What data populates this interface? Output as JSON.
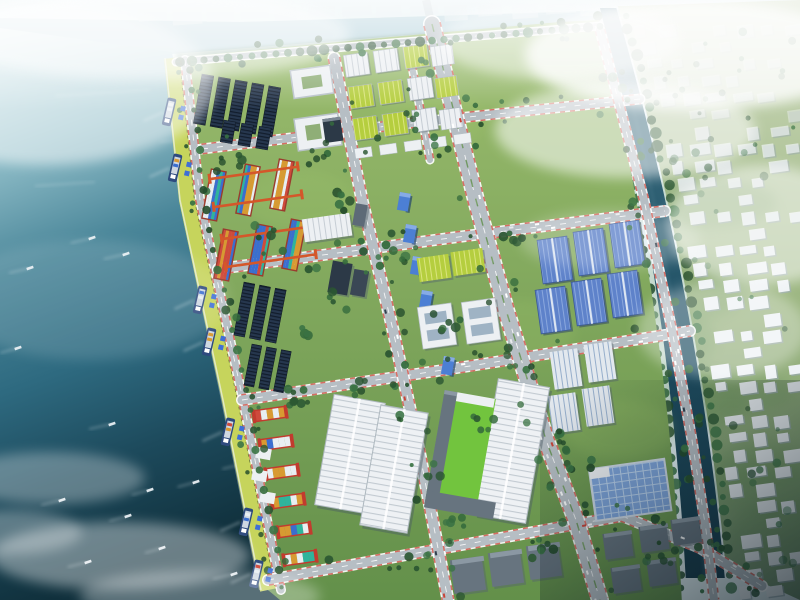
{
  "meta": {
    "type": "aerial-architectural-rendering",
    "subject": "coastal industrial port and logistics park master plan",
    "view": "oblique bird's-eye",
    "width": 800,
    "height": 600
  },
  "scene": {
    "sea": {
      "position": "left",
      "moored_ships": 7,
      "small_boats": 16,
      "wake_streaks": 5,
      "clouds_bottom_left": 4
    },
    "quay": {
      "edge": "yellow-green apron with rail line",
      "portal_cranes": 7
    },
    "industrial_park": {
      "solar_panel_fields": 2,
      "container_yard_north": {
        "rows": 2,
        "stacks": 6,
        "gantry_cranes": "orange"
      },
      "container_yard_south": {
        "stacks": 6,
        "frames": "red"
      },
      "courtyard_buildings": 2,
      "workshop_rows": "white and yellow-green roofs",
      "office_cluster": "dark and gray mid-rise slabs",
      "blue_glass_towers": 6,
      "green_roof_buildings": 2,
      "white_panel_buildings": 2,
      "blue_warehouses": 6,
      "striped_warehouses": 4,
      "large_ribbed_warehouses": 3,
      "glass_roof_warehouse": 1,
      "sports_green_field": 1,
      "gray_warehouse_clusters": 2,
      "road_grid": {
        "vertical_roads": 4,
        "horizontal_roads": 5,
        "curbs": "red-white striped",
        "boulevard": "tree-lined median"
      }
    },
    "river": {
      "position": "right",
      "orientation": "north-south",
      "banks": "tree-lined",
      "bridges": 2
    },
    "east_bank_village": {
      "buildings": "small white low-rise blocks",
      "ground": "hazy green",
      "shading": "dark toward bottom-right"
    },
    "top_shoreline": {
      "water_band": true,
      "city_blocks": "hazy silhouettes",
      "bridge": true
    },
    "atmosphere": {
      "haze": "white cloud banks top-right, top-left and bottom-left",
      "lighting": "overcast daylight"
    }
  },
  "palette": {
    "haze_base": "#e3f0f3",
    "water_band": "#accdd7",
    "sea_stops": [
      "#d8ecef",
      "#8fbdc8",
      "#4a8699",
      "#2e6a80",
      "#1d4a5c",
      "#10303c"
    ],
    "grass_top": "#9cbd6e",
    "grass_bottom": "#63904a",
    "bright_field": "#72c43e",
    "quay_strip": "#c6d45c",
    "rail_dark": "#4e5a33",
    "road_gray": "#b6bec4",
    "curb_red": "#cf4a3f",
    "marking_white": "#ffffff",
    "solar_dark": "#26374e",
    "solar_line": "#121d2c",
    "roof_white": "#edf0f3",
    "roof_rib": "#c6cdd4",
    "roof_stripe_blue": "#96aecb",
    "roof_green": "#b5ce3f",
    "roof_green_line": "#dae57e",
    "roof_blue": "#5e82ca",
    "roof_blue_line": "#8fabdf",
    "glass_roof": "#7da3d9",
    "glass_line": "#b9d1ec",
    "tower_dark": "#2c3947",
    "tower_gray": "#5d6a77",
    "glass_tower": "#4c7fd4",
    "glass_tower_top": "#86abe6",
    "crane_orange": "#d4572a",
    "crane_red": "#c23b2e",
    "container_colors": [
      "#2fb49c",
      "#cf4a3c",
      "#e8eef2",
      "#3a6ed0",
      "#d89a32"
    ],
    "tree_greens": [
      "#2b5632",
      "#356b3c",
      "#244c2b",
      "#3a7344"
    ],
    "ship_hull": "#2e4a7e",
    "ship_deck": "#cfd8e2",
    "quay_crane_blue": "#3f6fd6",
    "river_top": "#3f7285",
    "river_bottom": "#173b4b",
    "village_green_top": "#cdd9bc",
    "village_green_bottom": "#74936b",
    "village_building": "#eef2f5",
    "village_shadow": "#9aa9b1",
    "city_silhouette": "#e2ebee",
    "dark_corner": "#0b1820",
    "warehouse_gray": "#67747f",
    "warehouse_gray_roof": "#8b98a3"
  }
}
